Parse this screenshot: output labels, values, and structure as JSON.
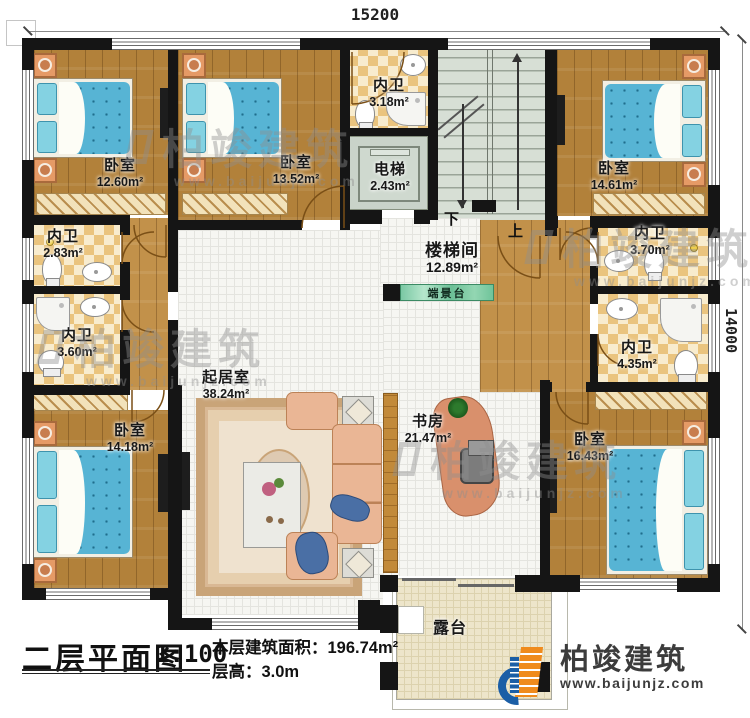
{
  "dimensions": {
    "top": "15200",
    "right": "14000"
  },
  "rooms": {
    "bedroom_tl": {
      "name": "卧室",
      "area": "12.60m²"
    },
    "bedroom_tm": {
      "name": "卧室",
      "area": "13.52m²"
    },
    "bath_tm": {
      "name": "内卫",
      "area": "3.18m²"
    },
    "elevator": {
      "name": "电梯",
      "area": "2.43m²"
    },
    "stairwell": {
      "name": "楼梯间",
      "area": "12.89m²"
    },
    "bedroom_tr": {
      "name": "卧室",
      "area": "14.61m²"
    },
    "bath_l1": {
      "name": "内卫",
      "area": "2.83m²"
    },
    "bath_l2": {
      "name": "内卫",
      "area": "3.60m²"
    },
    "bath_r1": {
      "name": "内卫",
      "area": "3.70m²"
    },
    "bath_r2": {
      "name": "内卫",
      "area": "4.35m²"
    },
    "bedroom_bl": {
      "name": "卧室",
      "area": "14.18m²"
    },
    "living": {
      "name": "起居室",
      "area": "38.24m²"
    },
    "study": {
      "name": "书房",
      "area": "21.47m²"
    },
    "bedroom_br": {
      "name": "卧室",
      "area": "16.43m²"
    },
    "terrace": {
      "name": "露台"
    },
    "view_platform": {
      "name": "端景台"
    }
  },
  "stairs": {
    "down": "下",
    "up": "上"
  },
  "title_block": {
    "title": "二层平面图",
    "scale": "1:100",
    "area_text": "本层建筑面积：196.74m²",
    "height_text": "层高：3.0m"
  },
  "logo": {
    "name": "柏竣建筑",
    "url": "www.baijunjz.com"
  },
  "watermark": {
    "text": "柏竣建筑",
    "url": "www.baijunjz.com"
  },
  "colors": {
    "wall": "#151515",
    "wood": "#b2813a",
    "accent_teal": "#7ac8a4",
    "logo_blue": "#1b5ea6",
    "logo_orange": "#ef8b1d"
  }
}
